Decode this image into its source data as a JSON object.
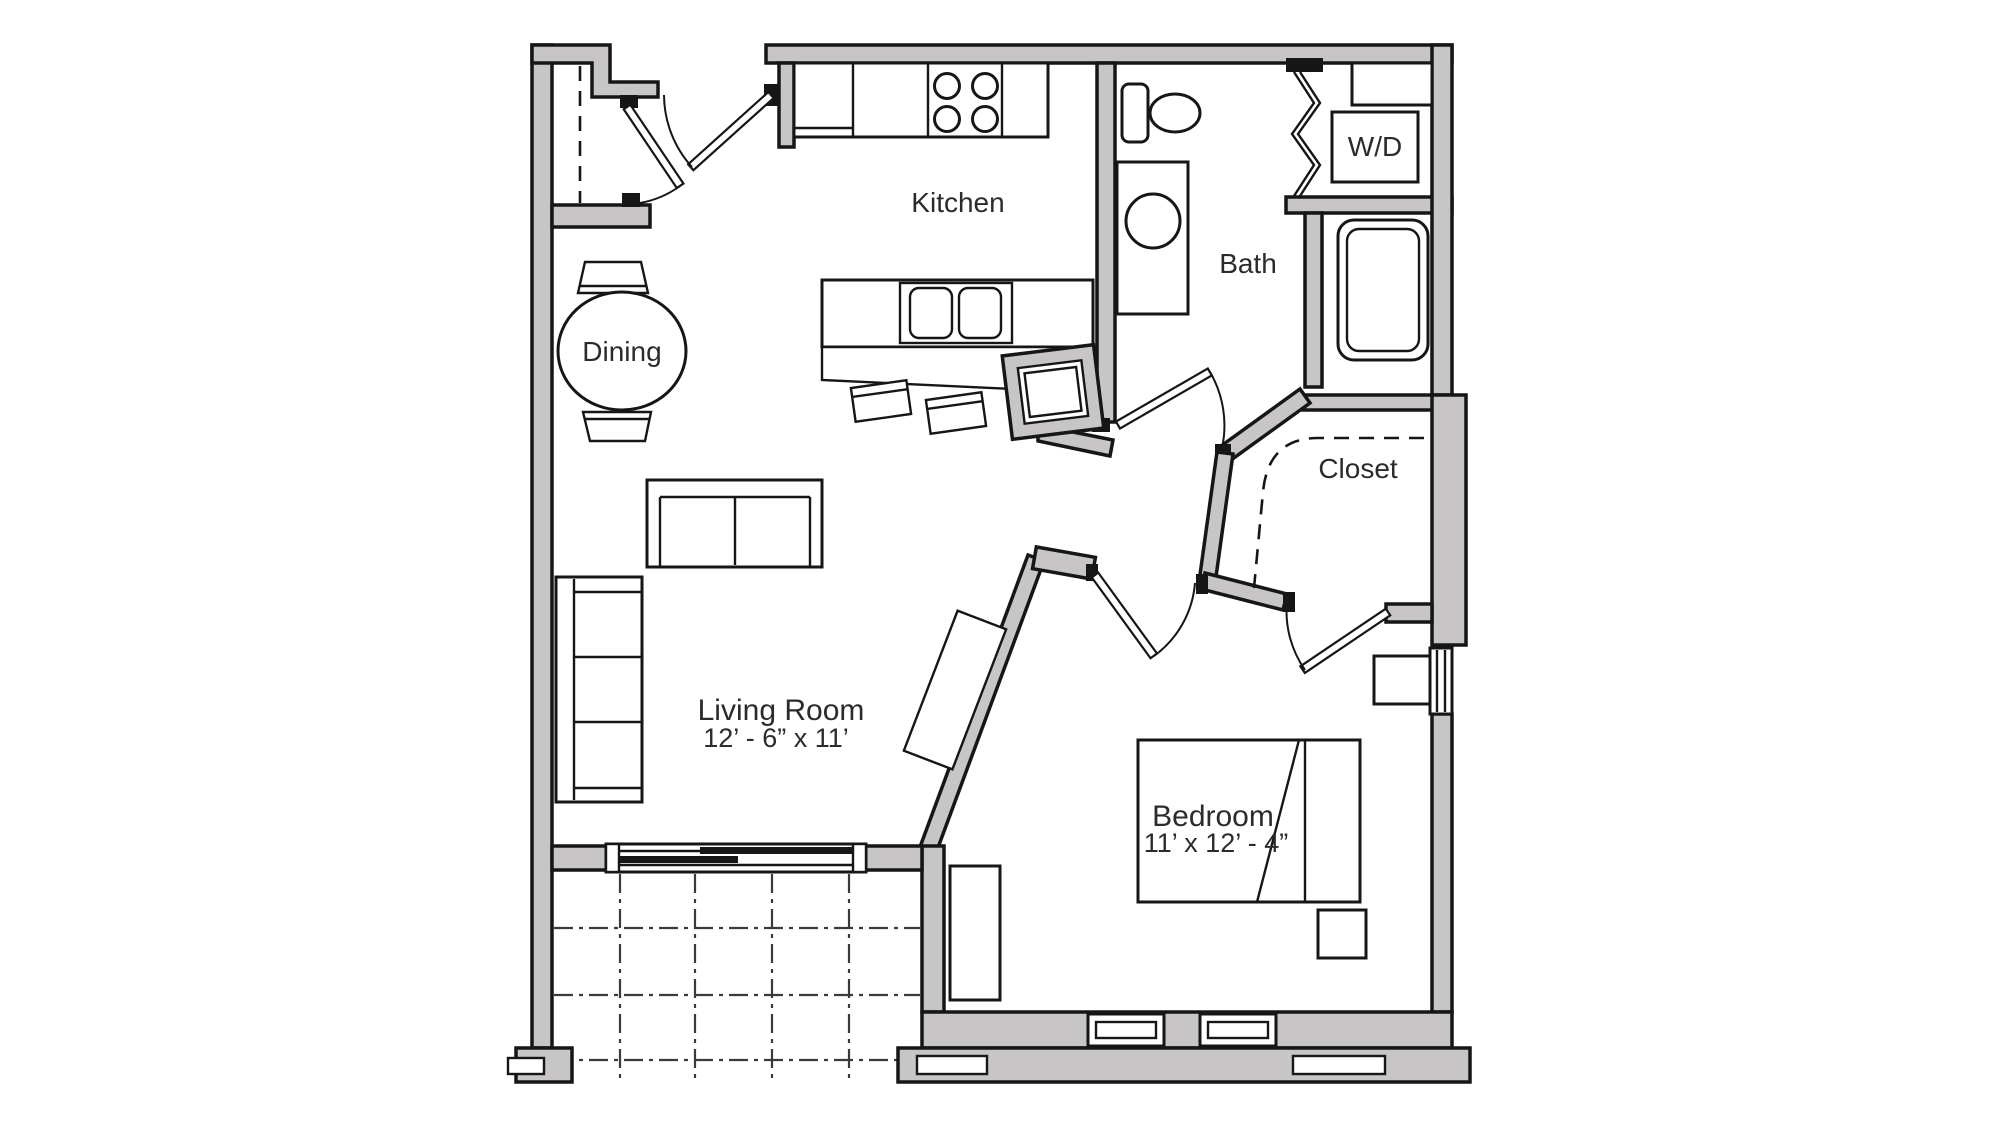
{
  "floor_plan": {
    "labels": {
      "kitchen": "Kitchen",
      "bath": "Bath",
      "laundry": "W/D",
      "dining": "Dining",
      "closet": "Closet",
      "living_room": {
        "name": "Living Room",
        "dims": "12’ - 6” x 11’"
      },
      "bedroom": {
        "name": "Bedroom",
        "dims": "11’ x 12’ - 4”"
      }
    },
    "colors": {
      "wall_fill": "#c7c5c5",
      "outline": "#161616",
      "text": "#2b2b2b",
      "grid_line": "#3a3a3a"
    },
    "fixtures": [
      "entry-door",
      "entry-closet-door",
      "entry-closet-rod",
      "kitchen-counter",
      "stove-burners",
      "peninsula-counter",
      "double-sink",
      "bar-stool",
      "pantry-cabinet",
      "dining-table",
      "dining-chair",
      "toilet",
      "vanity-sink",
      "bathtub",
      "washer-dryer",
      "laundry-shelf",
      "bifold-door",
      "walk-in-closet-rod",
      "closet-door",
      "sofa",
      "loveseat",
      "console-table",
      "bed",
      "nightstand",
      "dresser",
      "sliding-glass-door",
      "patio-tile-grid",
      "bedroom-window",
      "side-window"
    ]
  }
}
